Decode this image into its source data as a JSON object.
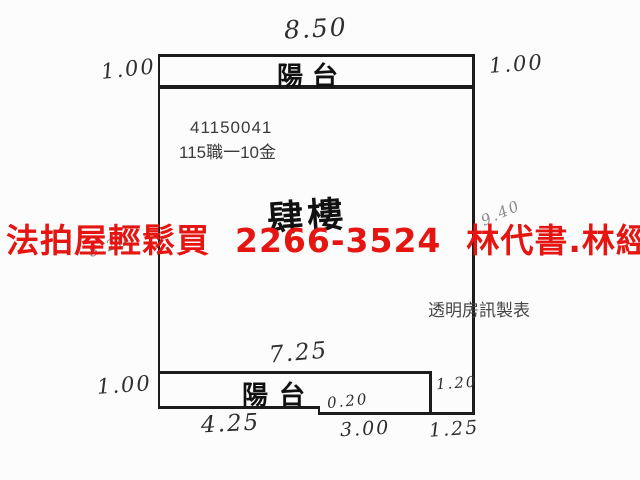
{
  "floorplan": {
    "property_id": "41150041",
    "case_number": "115職一10金",
    "floor_name": "肆樓",
    "top_balcony_label": "陽台",
    "bottom_balcony_label": "陽台",
    "publisher_credit": "透明房訊製表",
    "dims": {
      "top_width": "8.50",
      "top_left_depth": "1.00",
      "top_right_depth": "1.00",
      "left_side": "8.20",
      "right_side": "9.40",
      "bottom_balcony_width": "7.25",
      "bottom_left_depth": "1.00",
      "step_depth": "0.20",
      "notch_height": "1.20",
      "bottom_seg_left": "4.25",
      "bottom_seg_mid": "3.00",
      "bottom_seg_right": "1.25"
    }
  },
  "ad_overlay": {
    "text": "法拍屋輕鬆買  2266-3524  林代書.林經理",
    "color": "#e51511"
  }
}
